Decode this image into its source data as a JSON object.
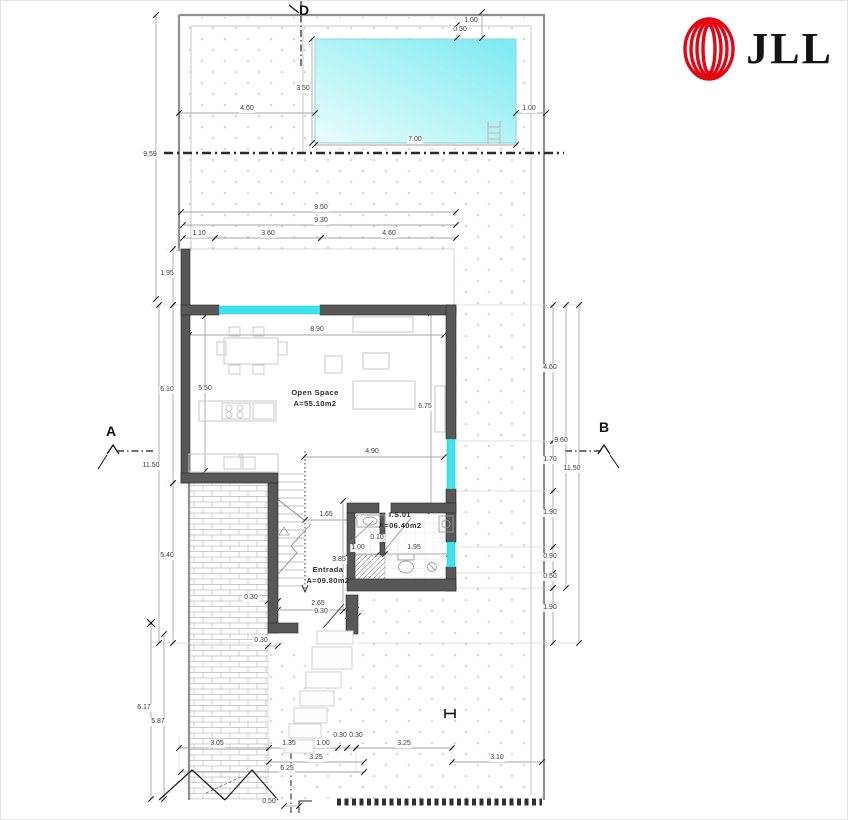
{
  "brand": {
    "name": "JLL",
    "mark_color": "#e30613",
    "text_color": "#131313"
  },
  "plan": {
    "rooms": [
      {
        "id": "open-space",
        "name": "Open Space",
        "area": "A=55.10m2",
        "x": 314,
        "y": 386
      },
      {
        "id": "entrada",
        "name": "Entrada",
        "area": "A=09.80m2",
        "x": 327,
        "y": 563
      },
      {
        "id": "is01",
        "name": "I.S.01",
        "area": "A=06.40m2",
        "x": 399,
        "y": 508
      }
    ],
    "section_markers": [
      {
        "label": "D",
        "x": 303,
        "y": 1
      },
      {
        "label": "A",
        "x": 110,
        "y": 422
      },
      {
        "label": "B",
        "x": 603,
        "y": 418
      }
    ],
    "dimensions": [
      {
        "t": "1.00",
        "x": 470,
        "y": 16
      },
      {
        "t": "0.50",
        "x": 459,
        "y": 25
      },
      {
        "t": "3.50",
        "x": 302,
        "y": 84
      },
      {
        "t": "4.60",
        "x": 246,
        "y": 104
      },
      {
        "t": "1.00",
        "x": 528,
        "y": 104
      },
      {
        "t": "7.00",
        "x": 414,
        "y": 135
      },
      {
        "t": "9.59",
        "x": 149,
        "y": 150
      },
      {
        "t": "9.50",
        "x": 320,
        "y": 203
      },
      {
        "t": "9.30",
        "x": 320,
        "y": 216
      },
      {
        "t": "1.10",
        "x": 198,
        "y": 229
      },
      {
        "t": "3.60",
        "x": 267,
        "y": 229
      },
      {
        "t": "4.60",
        "x": 388,
        "y": 229
      },
      {
        "t": "1.95",
        "x": 166,
        "y": 269
      },
      {
        "t": "8.90",
        "x": 316,
        "y": 325
      },
      {
        "t": "4.60",
        "x": 549,
        "y": 363
      },
      {
        "t": "5.50",
        "x": 204,
        "y": 384
      },
      {
        "t": "6.10",
        "x": 166,
        "y": 385
      },
      {
        "t": "6.75",
        "x": 424,
        "y": 402
      },
      {
        "t": "9.60",
        "x": 560,
        "y": 436
      },
      {
        "t": "4.90",
        "x": 371,
        "y": 447
      },
      {
        "t": "1.70",
        "x": 549,
        "y": 455
      },
      {
        "t": "11.50",
        "x": 571,
        "y": 464
      },
      {
        "t": "11.50",
        "x": 150,
        "y": 461
      },
      {
        "t": "1.90",
        "x": 549,
        "y": 508
      },
      {
        "t": "1.65",
        "x": 325,
        "y": 510
      },
      {
        "t": "0.10",
        "x": 376,
        "y": 533
      },
      {
        "t": "1.00",
        "x": 357,
        "y": 543
      },
      {
        "t": "1.95",
        "x": 413,
        "y": 543
      },
      {
        "t": "5.40",
        "x": 166,
        "y": 551
      },
      {
        "t": "0.90",
        "x": 549,
        "y": 552
      },
      {
        "t": "3.85",
        "x": 338,
        "y": 555
      },
      {
        "t": "0.50",
        "x": 549,
        "y": 572
      },
      {
        "t": "0.30",
        "x": 250,
        "y": 593
      },
      {
        "t": "2.65",
        "x": 317,
        "y": 599
      },
      {
        "t": "1.90",
        "x": 549,
        "y": 603
      },
      {
        "t": "0.30",
        "x": 320,
        "y": 607
      },
      {
        "t": "0.30",
        "x": 260,
        "y": 636
      },
      {
        "t": "6.17",
        "x": 143,
        "y": 703
      },
      {
        "t": "5.87",
        "x": 157,
        "y": 717
      },
      {
        "t": "0.30",
        "x": 339,
        "y": 731
      },
      {
        "t": "0.30",
        "x": 355,
        "y": 731
      },
      {
        "t": "3.05",
        "x": 216,
        "y": 739
      },
      {
        "t": "1.35",
        "x": 288,
        "y": 739
      },
      {
        "t": "1.00",
        "x": 322,
        "y": 739
      },
      {
        "t": "3.25",
        "x": 403,
        "y": 739
      },
      {
        "t": "3.25",
        "x": 315,
        "y": 753
      },
      {
        "t": "3.10",
        "x": 496,
        "y": 753
      },
      {
        "t": "6.25",
        "x": 286,
        "y": 764
      },
      {
        "t": "0.50",
        "x": 268,
        "y": 797
      }
    ]
  },
  "colors": {
    "wall": "#585858",
    "window": "#3fe3ee",
    "pool_light": "#eafdfb",
    "pool_dark": "#7ce9f1",
    "ground_dots": "#cfe0c8",
    "dimension_text": "#3c3c3c",
    "brand_red": "#e30613"
  }
}
